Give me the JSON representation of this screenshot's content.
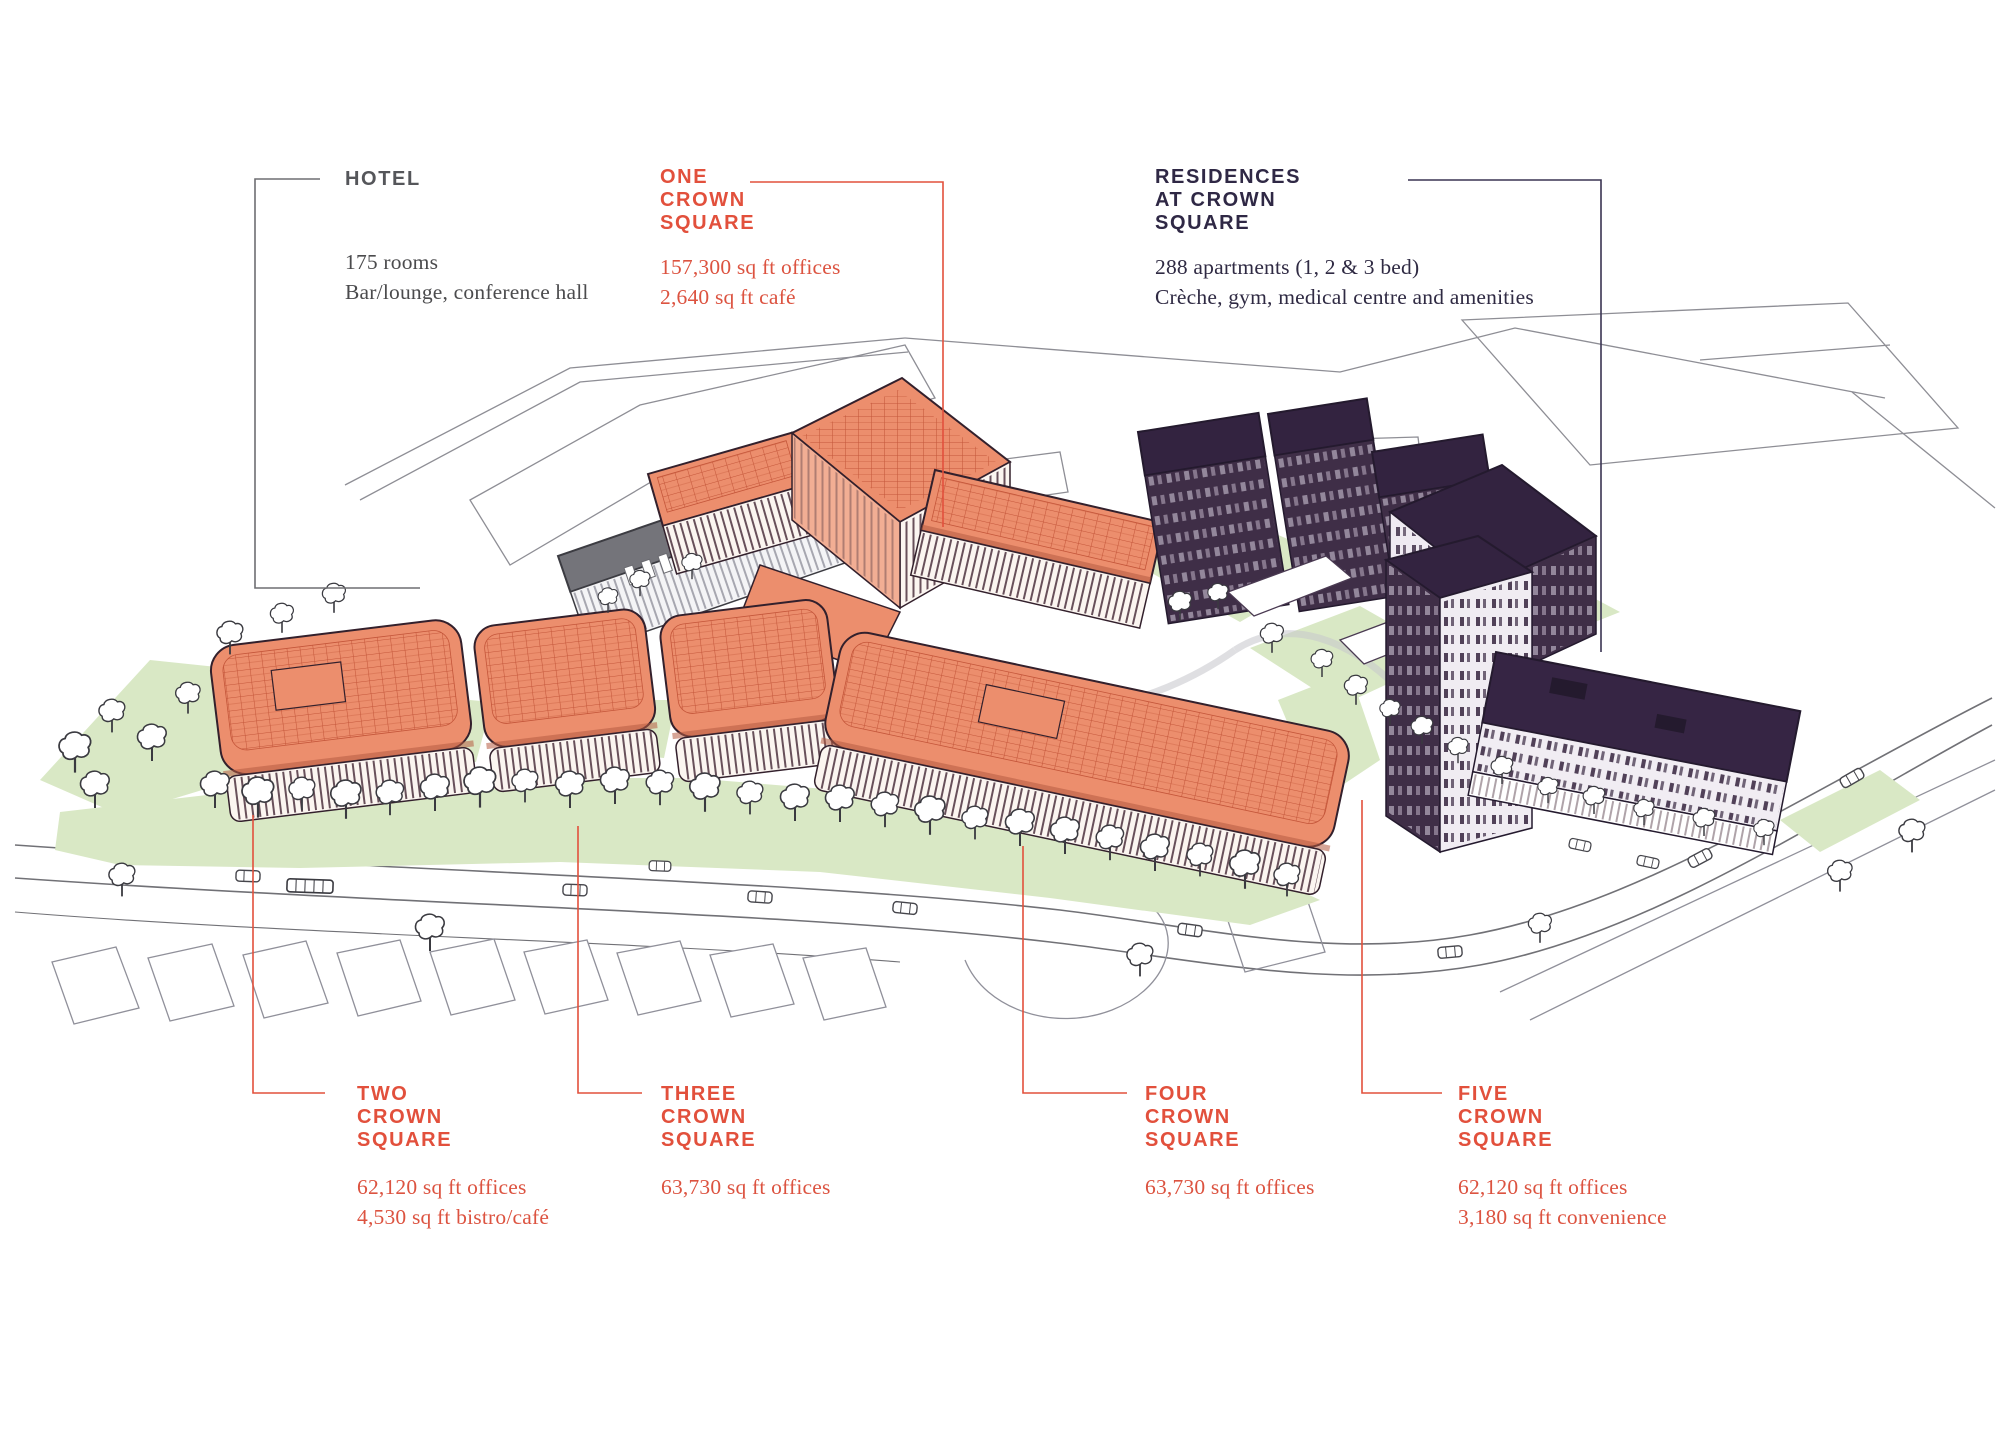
{
  "page": {
    "background": "#FFFFFF",
    "width": 2000,
    "height": 1444
  },
  "palette": {
    "accent_orange": "#E2503C",
    "dark_purple": "#2F2845",
    "label_gray": "#55565A",
    "building_salmon": "#EC8E6D",
    "building_dark": "#3F2E47",
    "landscape_green": "#D9E8C5"
  },
  "labels": {
    "hotel": {
      "title_lines": [
        "HOTEL"
      ],
      "detail_lines": [
        "175 rooms",
        "Bar/lounge, conference hall"
      ]
    },
    "one_crown_square": {
      "title_lines": [
        "ONE",
        "CROWN",
        "SQUARE"
      ],
      "detail_lines": [
        "157,300 sq ft offices",
        "2,640 sq ft café"
      ]
    },
    "residences": {
      "title_lines": [
        "RESIDENCES",
        "AT CROWN",
        "SQUARE"
      ],
      "detail_lines": [
        "288 apartments (1, 2 & 3 bed)",
        "Crèche, gym, medical centre and amenities"
      ]
    },
    "two_crown_square": {
      "title_lines": [
        "TWO",
        "CROWN",
        "SQUARE"
      ],
      "detail_lines": [
        "62,120 sq ft offices",
        "4,530 sq ft bistro/café"
      ]
    },
    "three_crown_square": {
      "title_lines": [
        "THREE",
        "CROWN",
        "SQUARE"
      ],
      "detail_lines": [
        "63,730 sq ft offices"
      ]
    },
    "four_crown_square": {
      "title_lines": [
        "FOUR",
        "CROWN",
        "SQUARE"
      ],
      "detail_lines": [
        "63,730 sq ft offices"
      ]
    },
    "five_crown_square": {
      "title_lines": [
        "62,120 sq ft offices",
        "3,180 sq ft convenience"
      ],
      "title_lines_head": [
        "FIVE",
        "CROWN",
        "SQUARE"
      ]
    }
  }
}
